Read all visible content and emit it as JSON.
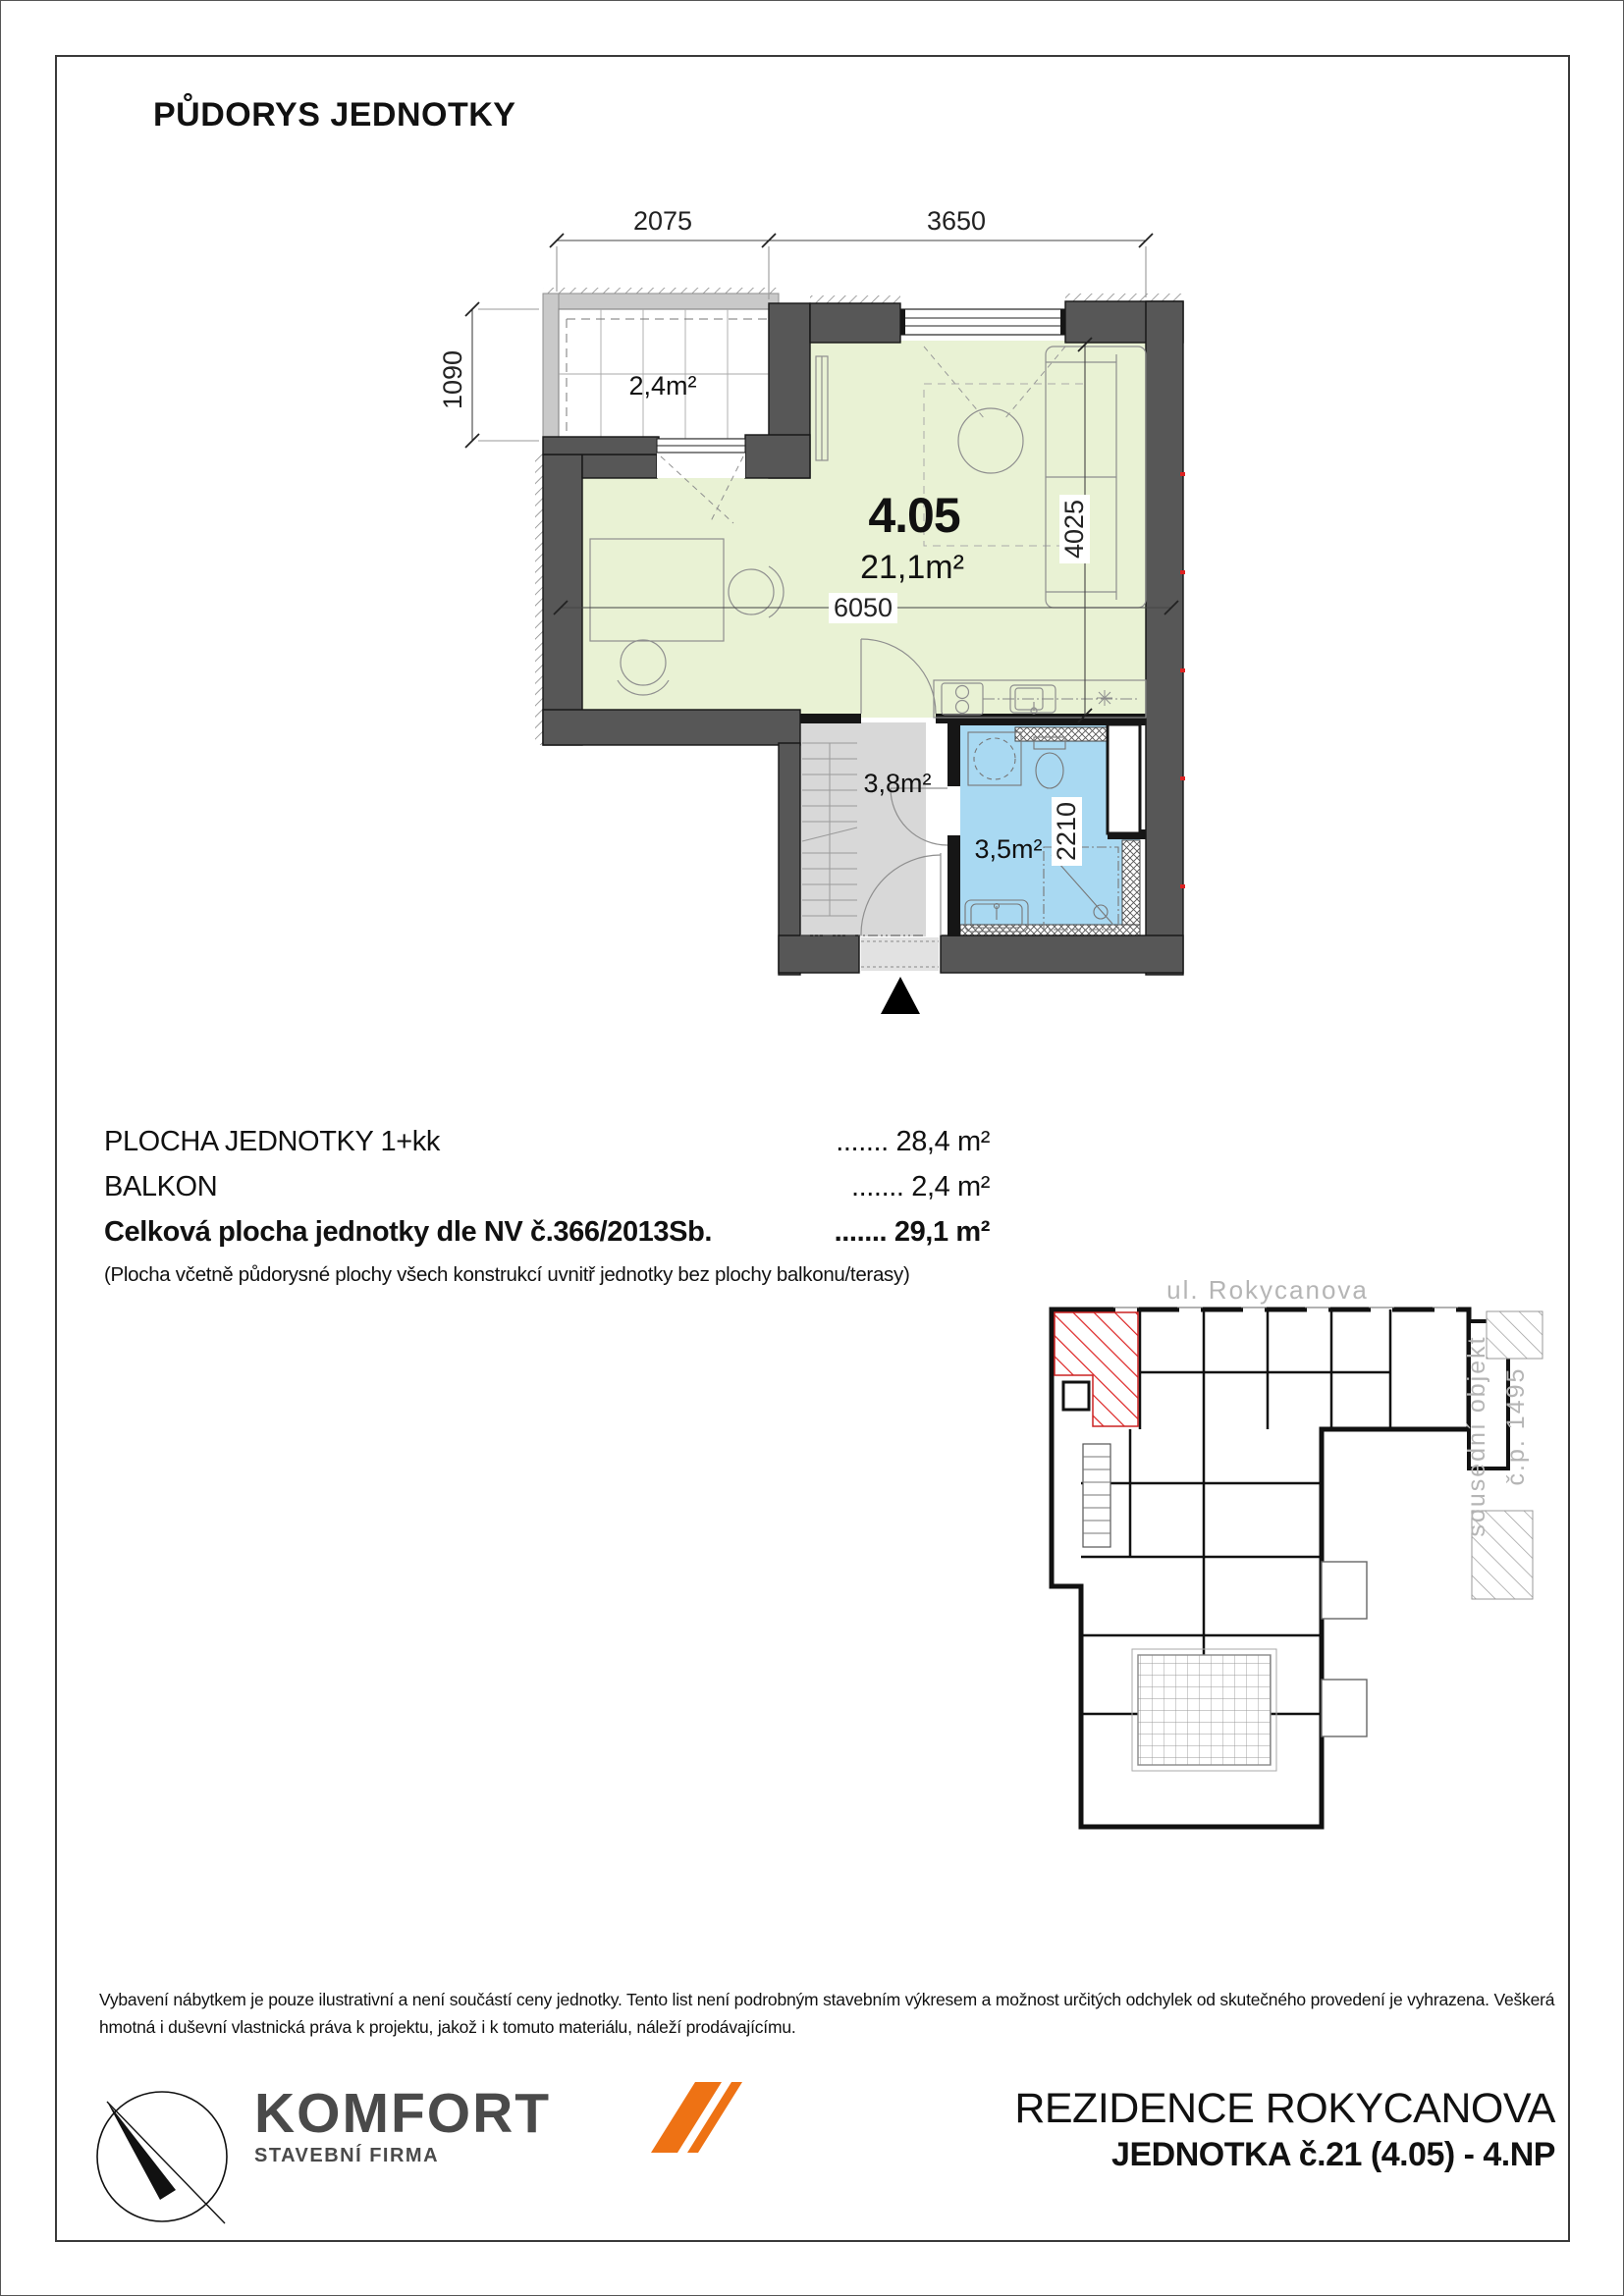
{
  "page": {
    "title": "PŮDORYS JEDNOTKY"
  },
  "plan": {
    "unit_number": "4.05",
    "unit_area": "21,1m²",
    "balcony_area": "2,4m²",
    "hall_area": "3,8m²",
    "bath_area": "3,5m²",
    "dims": {
      "balcony_width": "2075",
      "room_width": "3650",
      "balcony_depth": "1090",
      "unit_width": "6050",
      "room_depth": "4025",
      "bath_depth": "2210"
    }
  },
  "areas": {
    "rows": [
      {
        "label": "PLOCHA JEDNOTKY 1+kk",
        "value": "....... 28,4 m²"
      },
      {
        "label": "BALKON",
        "value": "....... 2,4 m²"
      },
      {
        "label": "Celková plocha jednotky dle NV č.366/2013Sb.",
        "value": "....... 29,1 m²"
      }
    ],
    "note": "(Plocha včetně půdorysné plochy všech konstrukcí uvnitř jednotky bez plochy balkonu/terasy)"
  },
  "siteplan": {
    "street": "ul. Rokycanova",
    "neighbor_line1": "sousední objekt",
    "neighbor_line2": "č.p. 1495"
  },
  "disclaimer": "Vybavení nábytkem je pouze ilustrativní a není součástí ceny jednotky. Tento list není podrobným stavebním výkresem a možnost určitých odchylek od skutečného provedení je vyhrazena. Veškerá hmotná i duševní vlastnická práva k projektu, jakož i k tomuto materiálu, náleží prodávajícímu.",
  "footer": {
    "brand": "KOMFORT",
    "brand_sub": "STAVEBNÍ FIRMA",
    "project": "REZIDENCE ROKYCANOVA",
    "unit_line": "JEDNOTKA č.21 (4.05) - 4.NP"
  },
  "colors": {
    "room_green": "#e9f2d4",
    "bath_blue": "#a9d9f2",
    "hall_gray": "#d8d8d8",
    "wall_gray": "#575757",
    "accent_orange": "#ee7214",
    "hatch_red": "#dd2222",
    "logo_gray": "#4a4a4a",
    "outline_gray": "#b5b5b5"
  }
}
